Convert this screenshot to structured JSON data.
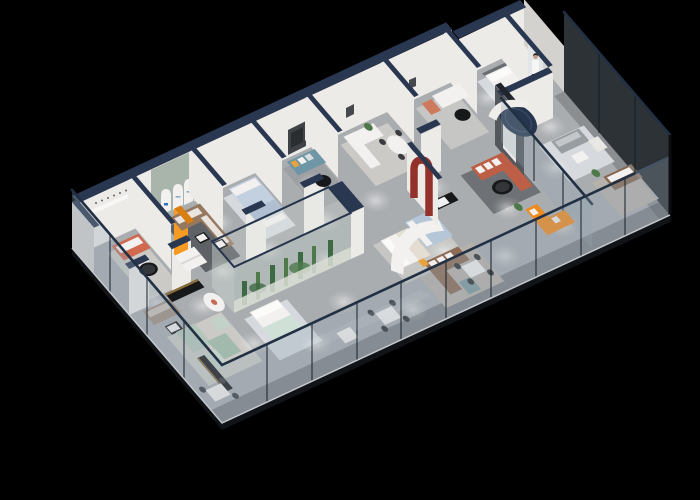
{
  "meta": {
    "description": "3D isometric cutaway rendering of a long furniture showroom floor plan on a black background: white walls with navy wall caps, glass curtain facades, gray floor with spotlight pools, and many furnished display vignettes (sofas, beds, dining sets, terrarium planter).",
    "canvas": {
      "width": 700,
      "height": 500
    }
  },
  "palette": {
    "bg": "#000000",
    "floor": "#aaadb0",
    "floorEdge": "#c6c8ca",
    "rugCream": "#cbcac6",
    "rugDark": "#5e6165",
    "rugSlate": "#6e7175",
    "rugLight": "#d6dade",
    "rugWarm": "#b6b1aa",
    "rugGray": "#9da0a3",
    "rugPale": "#c6c6c4",
    "wall": "#edebe8",
    "wallShade": "#d3d2cf",
    "archWall": "#a9b4aa",
    "darkWall": "#54575b",
    "cap": "#2a3750",
    "capDark": "#20252c",
    "rail": "#223044",
    "mullion": "rgba(20,30,42,0.7)",
    "glassTint": "rgba(150,166,178,0.30)",
    "fascia": "#101317",
    "white": "#f2f1ef",
    "offWhite": "#e9e7e3",
    "cream": "#e3ddd2",
    "black": "#17181a",
    "gold": "#8a6d3a",
    "coral": "#cf6a4f",
    "coralLight": "#cd7a5f",
    "terracotta": "#bd5f46",
    "walnut": "#96785f",
    "brown": "#8d6b54",
    "brownDeep": "#86664f",
    "taupe": "#a08e82",
    "sage": "#b3c7bb",
    "sageDeep": "#a2baae",
    "sagePale": "#c2d2c8",
    "mint": "#cfe0d6",
    "teal": "#6e96a6",
    "steel": "#7d9aa0",
    "paleBlue": "#c3d0e0",
    "blueBed": "#b5c6d8",
    "navy": "#26354e",
    "red": "#93312b",
    "orange": "#ef8a1d",
    "amber": "#f59b24",
    "amberDark": "#d97f12",
    "yellow": "#e8a33d",
    "green": "#4e7a4a",
    "greenDark": "#3e6a43",
    "gravel": "#d9ddd5",
    "logoBlue": "#2f6fbd",
    "skin": "#c69c83",
    "hair": "#262019",
    "tv": "#3f4347",
    "gray": "#979da1",
    "blanket": "#cbcbc9"
  },
  "scene": {
    "view": "isometric-cutaway",
    "building": "furniture-showroom",
    "vignettes": [
      {
        "name": "coral-sofa-lounge",
        "accent": "coral"
      },
      {
        "name": "arched-display-wall-lounge",
        "accent": "walnut"
      },
      {
        "name": "pale-blue-bedroom",
        "accent": "paleBlue"
      },
      {
        "name": "teal-sofa-media-room",
        "accent": "teal"
      },
      {
        "name": "white-sectional-dining-room",
        "accent": "white"
      },
      {
        "name": "white-sofa-coral-chair-lounge",
        "accent": "coralLight"
      },
      {
        "name": "white-bed-display",
        "accent": "white"
      },
      {
        "name": "orange-sofa-banner-corner",
        "accent": "orange"
      },
      {
        "name": "taupe-sofa-black-console",
        "accent": "taupe"
      },
      {
        "name": "sage-green-modular-group",
        "accent": "sage"
      },
      {
        "name": "mint-bed-display",
        "accent": "mint"
      },
      {
        "name": "terrarium-planter-case",
        "accent": "green"
      },
      {
        "name": "white-and-blue-bed-displays",
        "accent": "blueBed"
      },
      {
        "name": "red-arch-feature-wall",
        "accent": "red"
      },
      {
        "name": "dark-feature-wall-with-door",
        "accent": "darkWall"
      },
      {
        "name": "terracotta-sectional-lounge",
        "accent": "terracotta"
      },
      {
        "name": "bright-orange-sectional",
        "accent": "orange"
      },
      {
        "name": "brown-sectional-dining",
        "accent": "brown"
      },
      {
        "name": "glass-meeting-rooms",
        "accent": "glassTint"
      },
      {
        "name": "glass-curtain-facade",
        "accent": "glassTint"
      }
    ]
  }
}
